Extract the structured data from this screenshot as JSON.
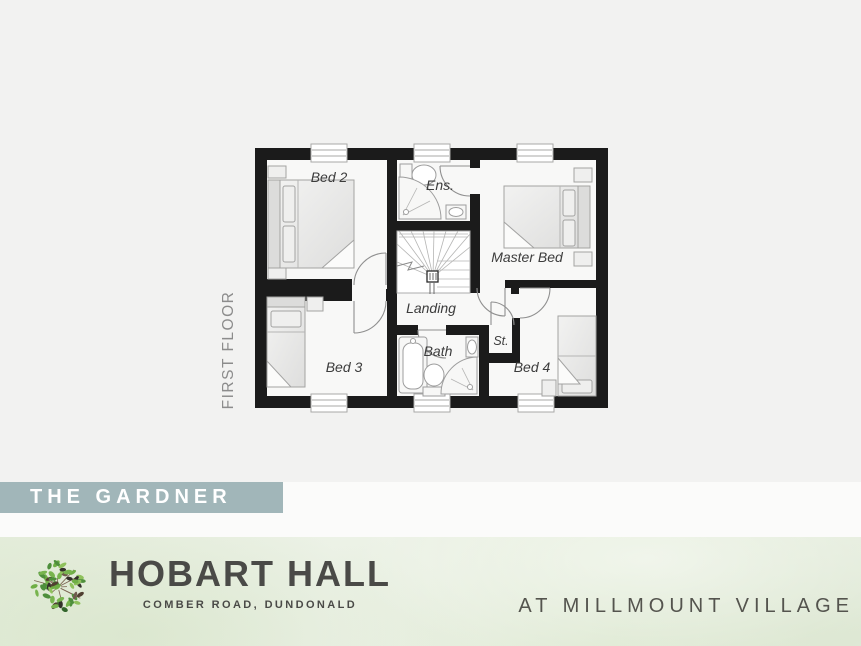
{
  "banner": {
    "title": "THE GARDNER"
  },
  "floorplan": {
    "floor_label": "FIRST FLOOR",
    "rooms": {
      "bed2": "Bed 2",
      "ensuite": "Ens.",
      "master": "Master Bed",
      "landing": "Landing",
      "bed3": "Bed 3",
      "bath": "Bath",
      "store": "St.",
      "bed4": "Bed 4"
    }
  },
  "footer": {
    "development_name": "HOBART HALL",
    "development_address": "COMBER ROAD, DUNDONALD",
    "location_line": "AT MILLMOUNT VILLAGE",
    "logo": "tree-of-leaves-icon"
  },
  "colors": {
    "page_background": "#f2f2f1",
    "banner_background": "#a1b6b9",
    "banner_text": "#ffffff",
    "wall": "#1b1b1b",
    "room_fill": "#f8f8f7",
    "footer_background": "#e7eedf",
    "footer_text": "#4a4a47",
    "room_label_text": "#3c3c3c",
    "floor_label_text": "#8c8c8c",
    "logo_greens": [
      "#4e8f3c",
      "#6fae45",
      "#8fc15c",
      "#33652c",
      "#78b44e"
    ],
    "logo_browns": [
      "#503f31",
      "#6e5c4c",
      "#33302a"
    ]
  }
}
